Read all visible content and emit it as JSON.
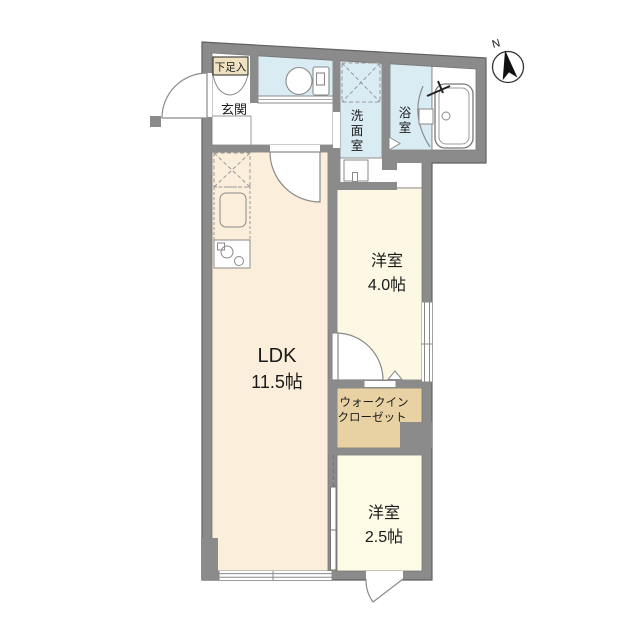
{
  "plan_title": "1LDK floor plan",
  "colors": {
    "wall": "#8b8b8b",
    "wall_edge": "#6a6a6a",
    "white": "#ffffff",
    "wet_blue": "#d9ecf4",
    "floor_ldk": "#fbeedb",
    "floor_room4": "#fdf8e3",
    "floor_room25": "#fdfae6",
    "wic_tan": "#e8d2a4",
    "shoe_box": "#efe2c0",
    "line": "#8a8a8a",
    "text": "#1a1a1a"
  },
  "compass": {
    "label": "N"
  },
  "rooms": {
    "genkan": {
      "label": "玄関"
    },
    "shoe": {
      "label": "下足入"
    },
    "washroom": {
      "chars": [
        "洗",
        "面",
        "室"
      ]
    },
    "bath": {
      "chars": [
        "浴",
        "室"
      ]
    },
    "western4": {
      "label": "洋室",
      "size": "4.0帖"
    },
    "ldk": {
      "label": "LDK",
      "size": "11.5帖"
    },
    "wic": {
      "line1": "ウォークイン",
      "line2": "クローゼット"
    },
    "western25": {
      "label": "洋室",
      "size": "2.5帖"
    }
  }
}
